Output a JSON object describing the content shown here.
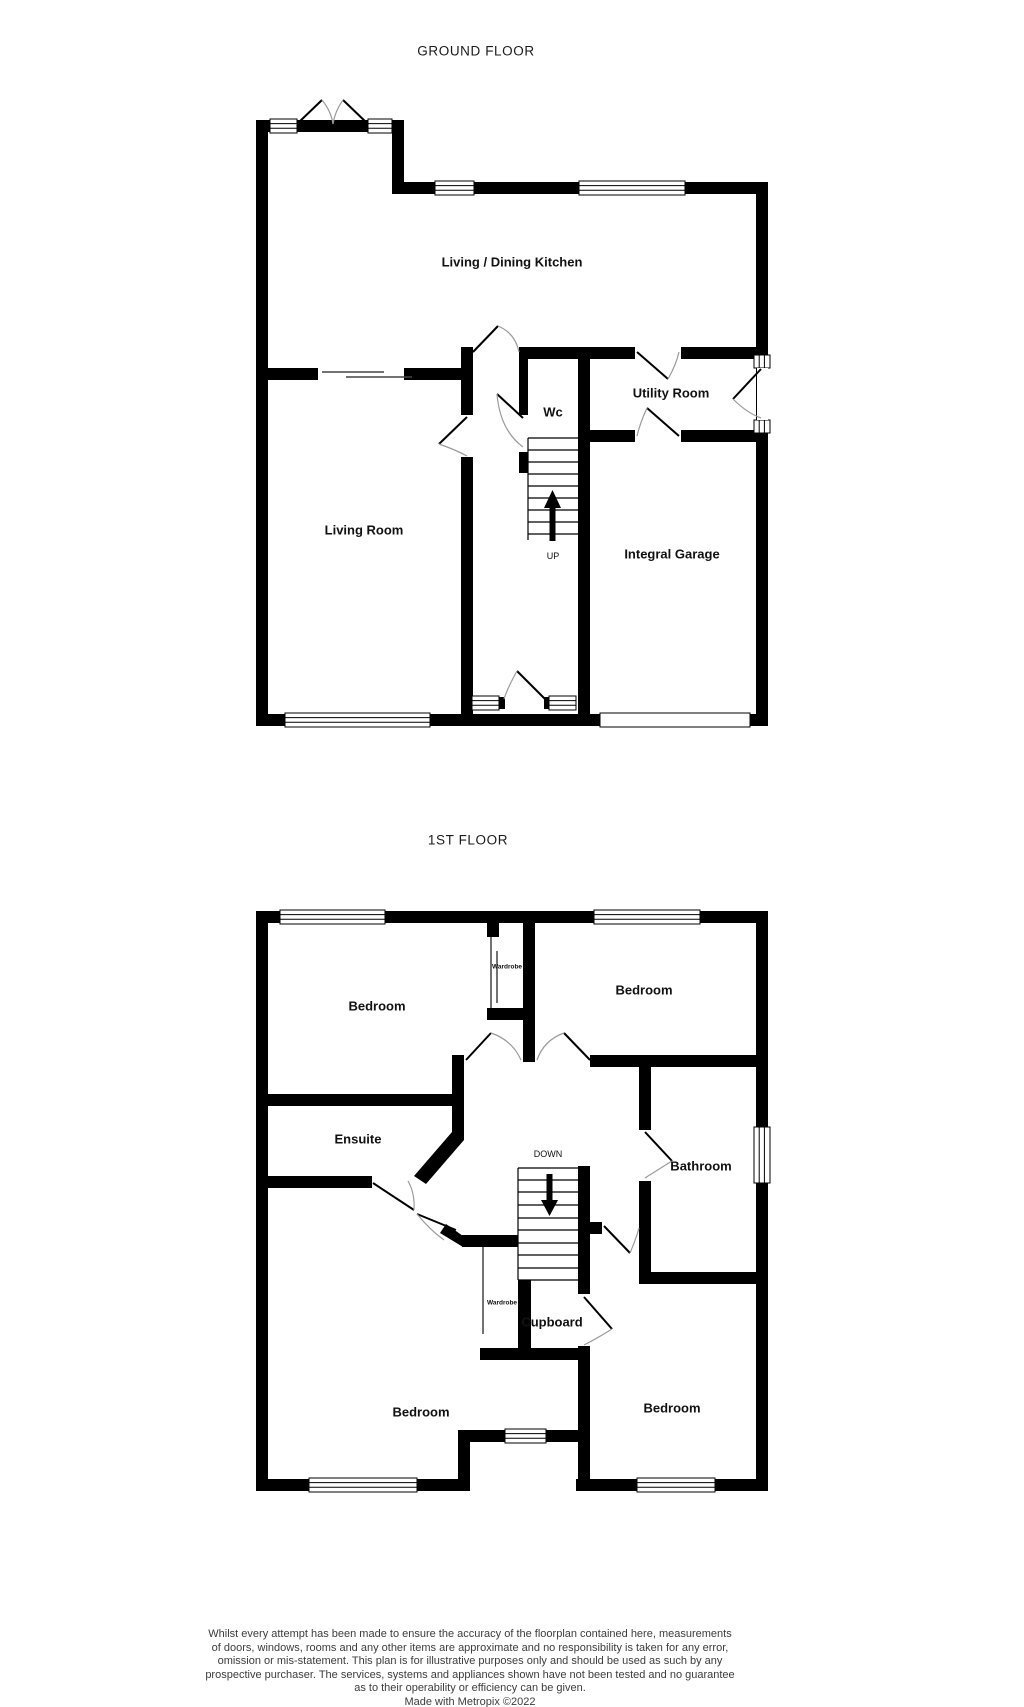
{
  "page": {
    "background": "#ffffff"
  },
  "colors": {
    "wall": "#000000",
    "door_arc": "#9a9a9a",
    "label_text": "#111111",
    "disclaimer_text": "#3c3c3c"
  },
  "ground_floor": {
    "title": "GROUND FLOOR",
    "labels": {
      "kitchen": "Living / Dining Kitchen",
      "living_room": "Living Room",
      "wc": "Wc",
      "utility_room": "Utility Room",
      "garage": "Integral Garage",
      "stairs_direction": "UP"
    }
  },
  "first_floor": {
    "title": "1ST FLOOR",
    "labels": {
      "bedroom_top_left": "Bedroom",
      "bedroom_top_right": "Bedroom",
      "bedroom_bottom_left": "Bedroom",
      "bedroom_bottom_right": "Bedroom",
      "ensuite": "Ensuite",
      "bathroom": "Bathroom",
      "cupboard": "Cupboard",
      "wardrobe_top": "Wardrobe",
      "wardrobe_bottom": "Wardrobe",
      "stairs_direction": "DOWN"
    }
  },
  "footer": {
    "disclaimer_lines": [
      "Whilst every attempt has been made to ensure the accuracy of the floorplan contained here, measurements",
      "of doors, windows, rooms and any other items are approximate and no responsibility is taken for any error,",
      "omission or mis-statement. This plan is for illustrative purposes only and should be used as such by any",
      "prospective purchaser. The services, systems and appliances shown have not been tested and no guarantee",
      "as to their operability or efficiency can be given."
    ],
    "credit": "Made with Metropix ©2022"
  }
}
